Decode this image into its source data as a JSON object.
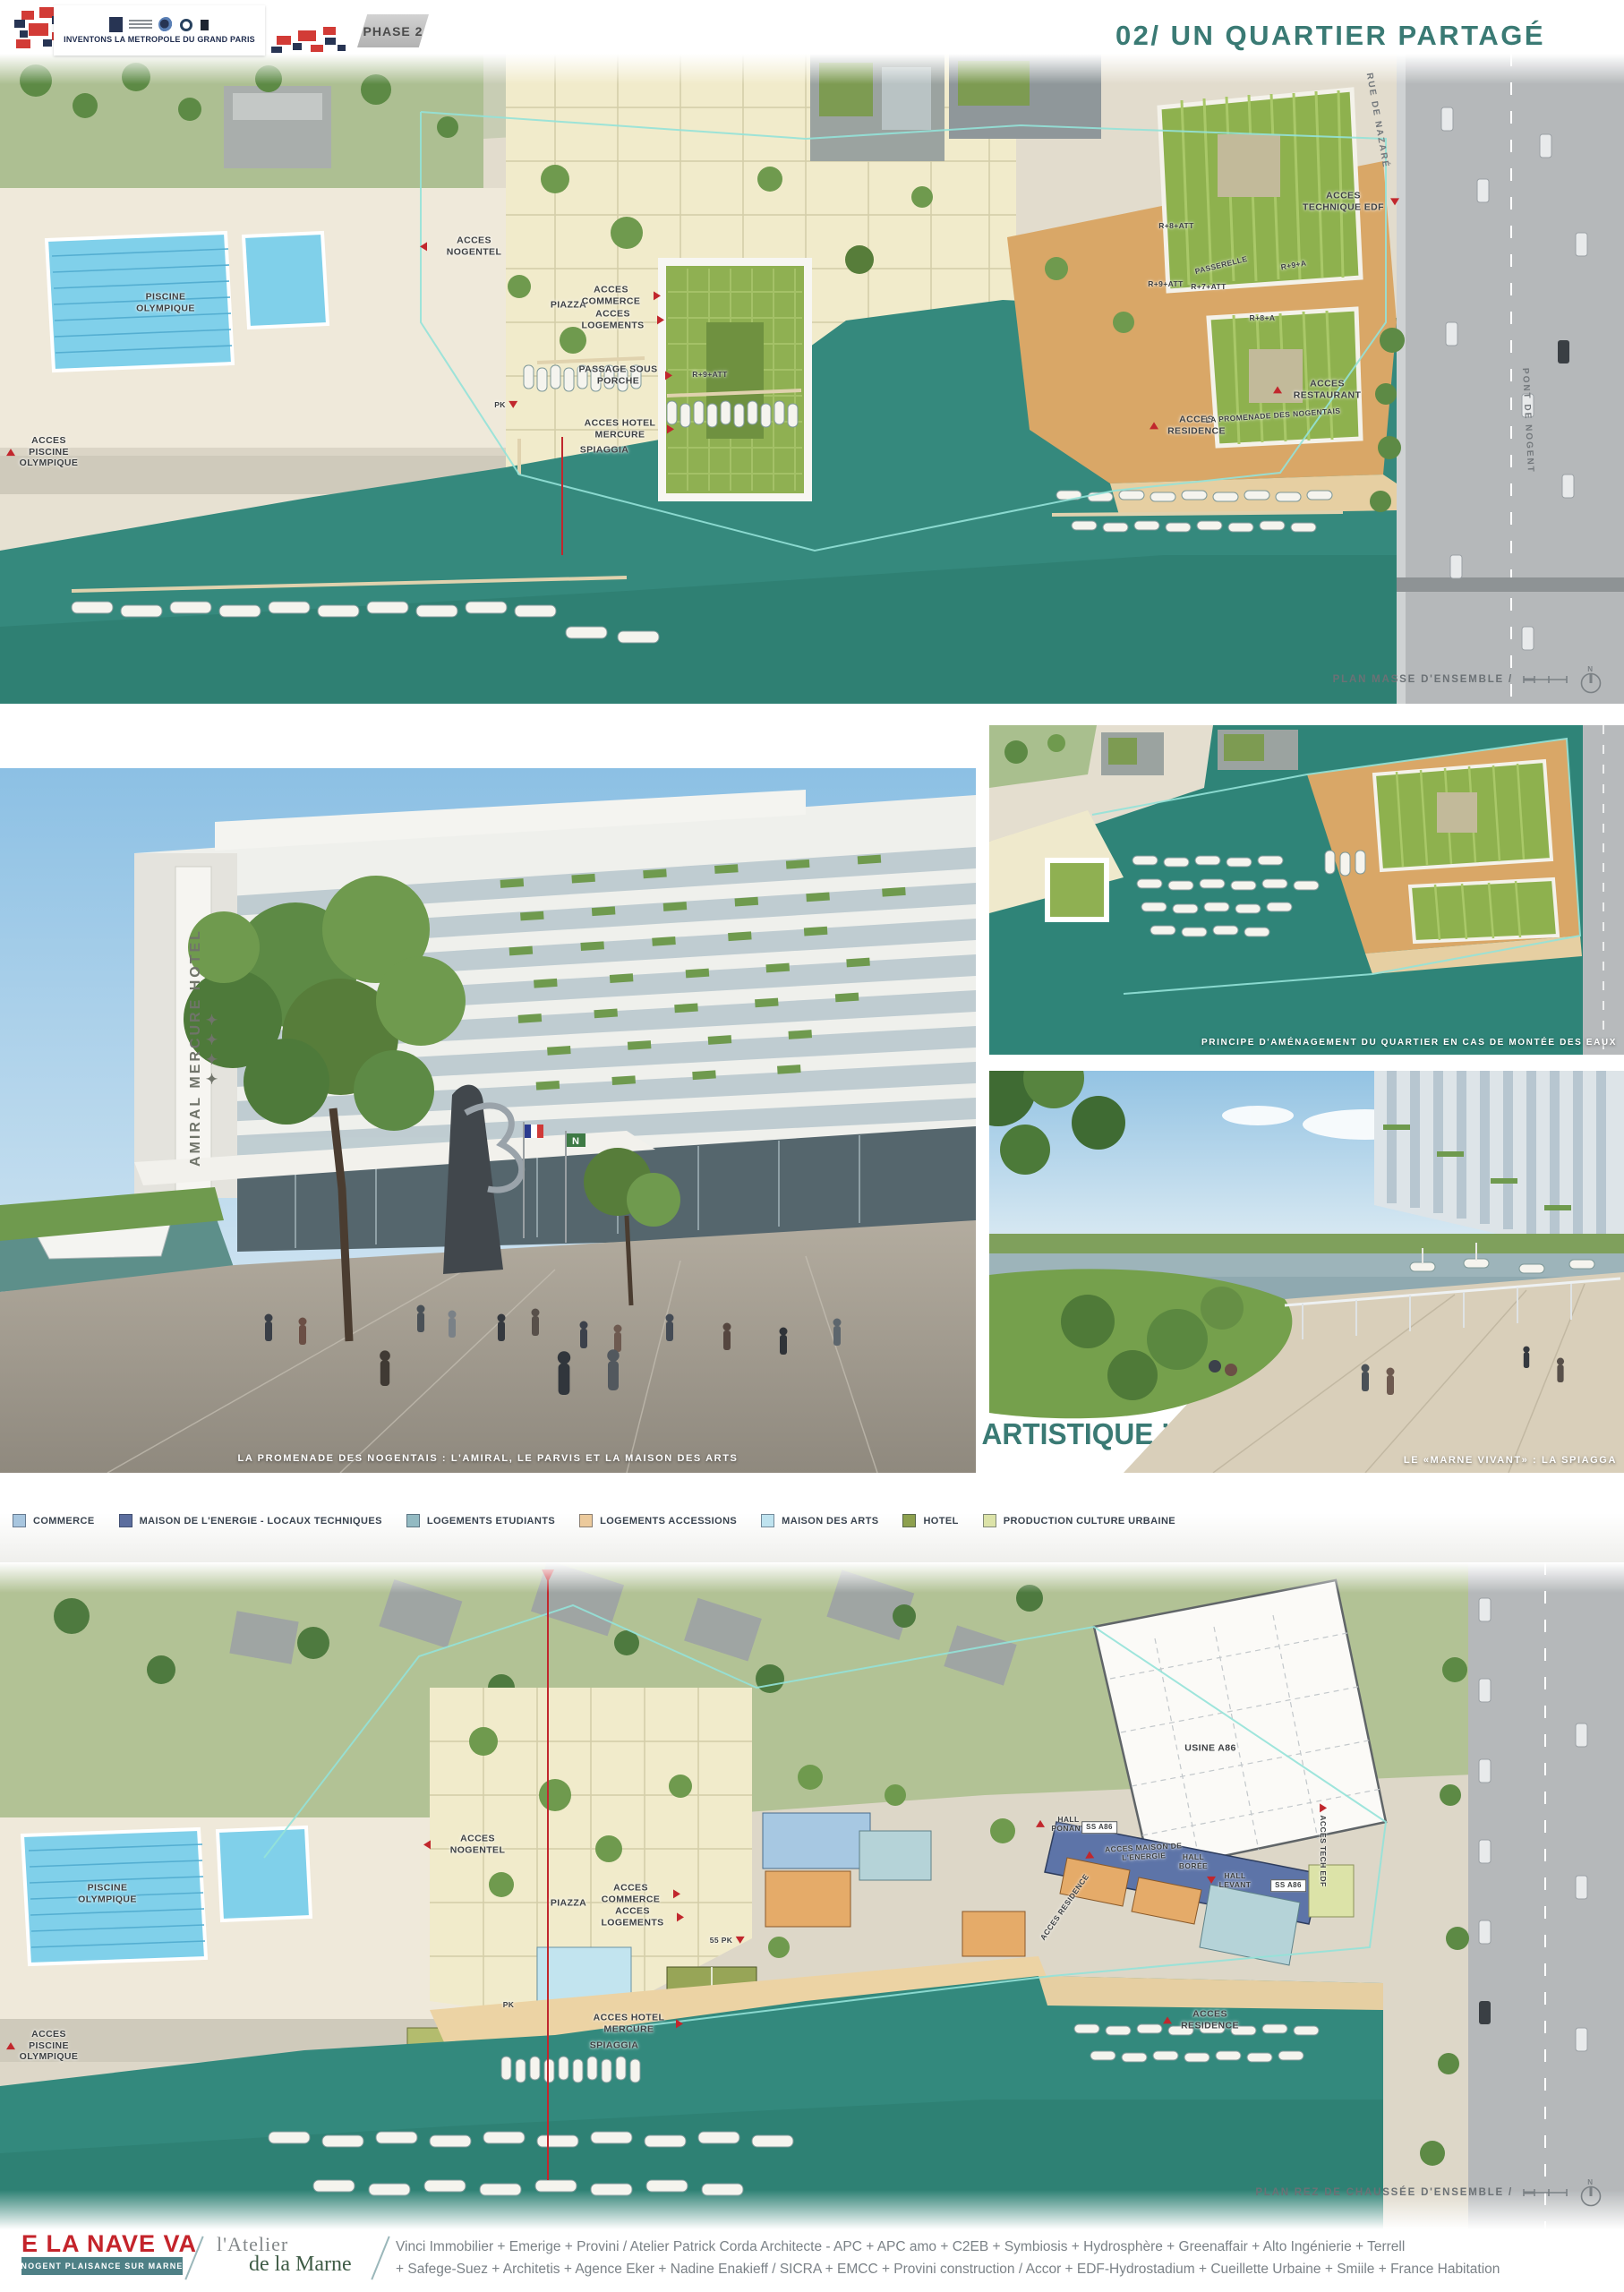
{
  "header": {
    "inventons_label": "INVENTONS LA METROPOLE DU GRAND PARIS",
    "phase_label": "PHASE 2",
    "title": "02/ UN QUARTIER PARTAGÉ"
  },
  "quote": {
    "lead": "“ HAUTE QUALITÉ ENVIRONNEMENTALE, SOCIALE, CULTURELLE ",
    "et": "ET",
    "tail": " ARTISTIQUE.”"
  },
  "plan_masse": {
    "caption": "PLAN MASSE D'ENSEMBLE /",
    "labels": [
      {
        "text": "PISCINE OLYMPIQUE"
      },
      {
        "text": "ACCES PISCINE OLYMPIQUE"
      },
      {
        "text": "ACCES NOGENTEL"
      },
      {
        "text": "PIAZZA"
      },
      {
        "text": "ACCES COMMERCE"
      },
      {
        "text": "ACCES LOGEMENTS"
      },
      {
        "text": "PASSAGE SOUS PORCHE"
      },
      {
        "text": "ACCES HOTEL MERCURE"
      },
      {
        "text": "SPIAGGIA"
      },
      {
        "text": "PK"
      },
      {
        "text": "R+9+ATT"
      },
      {
        "text": "ACCES TECHNIQUE EDF"
      },
      {
        "text": "RUE DE NAZARÉ"
      },
      {
        "text": "PASSERELLE"
      },
      {
        "text": "R+8+ATT"
      },
      {
        "text": "R+9+A"
      },
      {
        "text": "R+7+ATT"
      },
      {
        "text": "R+9+ATT"
      },
      {
        "text": "R+8+A"
      },
      {
        "text": "ACCES RESTAURANT"
      },
      {
        "text": "ACCES RESIDENCE"
      },
      {
        "text": "LA PROMENADE DES NOGENTAIS"
      },
      {
        "text": "PONT DE NOGENT"
      }
    ]
  },
  "flood_plan": {
    "caption": "PRINCIPE D'AMÉNAGEMENT DU QUARTIER EN CAS DE MONTÉE DES EAUX"
  },
  "promenade": {
    "caption": "LA PROMENADE DES NOGENTAIS : L'AMIRAL, LE PARVIS ET LA MAISON DES ARTS",
    "building_sign": "AMIRAL MERCURE HOTEL ✦✦✦✦"
  },
  "marne_vivant": {
    "caption": "LE «MARNE VIVANT» : LA SPIAGGA"
  },
  "legend": {
    "items": [
      {
        "label": "COMMERCE",
        "color": "#a8c6df"
      },
      {
        "label": "MAISON DE L'ENERGIE - LOCAUX TECHNIQUES",
        "color": "#5c6e9e"
      },
      {
        "label": "LOGEMENTS ETUDIANTS",
        "color": "#93bac2"
      },
      {
        "label": "LOGEMENTS ACCESSIONS",
        "color": "#ecca9c"
      },
      {
        "label": "MAISON DES ARTS",
        "color": "#bfe3ef"
      },
      {
        "label": "HOTEL",
        "color": "#8da04e"
      },
      {
        "label": "PRODUCTION CULTURE URBAINE",
        "color": "#dce3a8"
      }
    ]
  },
  "plan_rdc": {
    "caption": "PLAN REZ DE CHAUSSÉE D'ENSEMBLE /",
    "labels": [
      {
        "text": "PISCINE OLYMPIQUE"
      },
      {
        "text": "ACCES PISCINE OLYMPIQUE"
      },
      {
        "text": "ACCES NOGENTEL"
      },
      {
        "text": "PIAZZA"
      },
      {
        "text": "ACCES COMMERCE"
      },
      {
        "text": "ACCES LOGEMENTS"
      },
      {
        "text": "55 PK"
      },
      {
        "text": "PK"
      },
      {
        "text": "ACCES HOTEL MERCURE"
      },
      {
        "text": "SPIAGGIA"
      },
      {
        "text": "USINE A86"
      },
      {
        "text": "HALL PONANT"
      },
      {
        "text": "SS A86"
      },
      {
        "text": "ACCES MAISON DE L'ENERGIE"
      },
      {
        "text": "HALL BORÉE"
      },
      {
        "text": "HALL LEVANT"
      },
      {
        "text": "ACCES RESIDENCE"
      },
      {
        "text": "SS A86"
      },
      {
        "text": "ACCES TECH EDF"
      },
      {
        "text": "ACCES RESIDENCE"
      }
    ]
  },
  "footer": {
    "logo_title": "E LA NAVE VA",
    "logo_subtitle": "NOGENT PLAISANCE SUR MARNE",
    "atelier_line1": "l'Atelier",
    "atelier_line2": "de la Marne",
    "partners_line1": "Vinci Immobilier + Emerige + Provini / Atelier Patrick Corda Architecte - APC + APC amo + C2EB + Symbiosis + Hydrosphère + Greenaffair + Alto Ingénierie + Terrell",
    "partners_line2": "+ Safege-Suez + Architetis + Agence Eker + Nadine Enakieff / SICRA + EMCC + Provini construction / Accor + EDF-Hydrostadium + Cueillette Urbaine + Smiile + France Habitation"
  },
  "icons": {
    "access_marker": "red-triangle",
    "north_arrow": "compass-N",
    "scale_bar": "scale-bar"
  },
  "colors": {
    "accent_teal": "#3a7a74",
    "water": "#35897d",
    "brand_red": "#c4242b",
    "footer_teal": "#4e8086"
  }
}
